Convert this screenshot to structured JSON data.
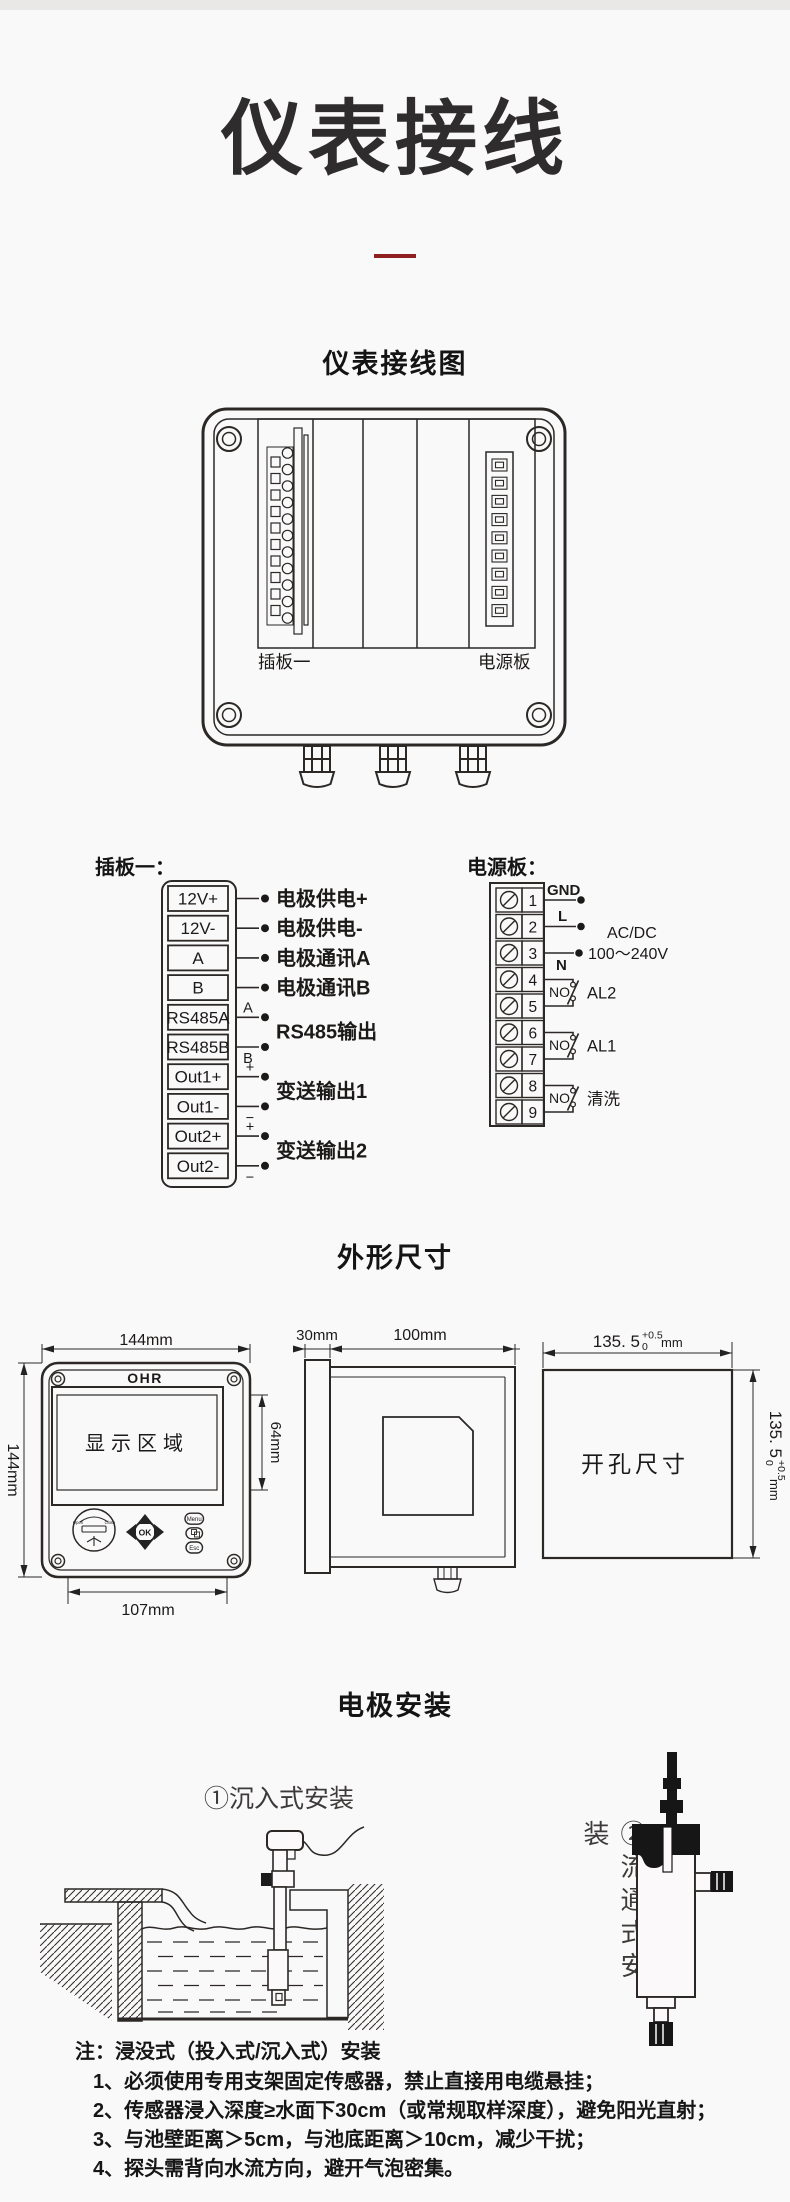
{
  "page": {
    "title": "仪表接线",
    "section_wiring_heading": "仪表接线图",
    "section_dimensions_heading": "外形尺寸",
    "section_electrode_heading": "电极安装",
    "colors": {
      "accent_red": "#8e2020",
      "line": "#2b2826",
      "background": "#faf9f9"
    }
  },
  "enclosure": {
    "left_slot_label": "插板一",
    "right_slot_label": "电源板"
  },
  "plugboard": {
    "title": "插板一：",
    "terminals": [
      "12V+",
      "12V-",
      "A",
      "B",
      "RS485A",
      "RS485B",
      "Out1+",
      "Out1-",
      "Out2+",
      "Out2-"
    ],
    "labels": {
      "supply_pos": "电极供电+",
      "supply_neg": "电极供电-",
      "comm_a": "电极通讯A",
      "comm_b": "电极通讯B",
      "rs485": "RS485输出",
      "rs485_a": "A",
      "rs485_b": "B",
      "out1": "变送输出1",
      "out2": "变送输出2",
      "plus": "+",
      "minus": "−"
    }
  },
  "powerboard": {
    "title": "电源板：",
    "terminals": [
      "1",
      "2",
      "3",
      "4",
      "5",
      "6",
      "7",
      "8",
      "9"
    ],
    "labels": {
      "gnd": "GND",
      "live": "L",
      "neutral": "N",
      "acdc_line1": "AC/DC",
      "acdc_line2": "100～240V",
      "no": "NO",
      "al2": "AL2",
      "al1": "AL1",
      "wash": "清洗"
    }
  },
  "dimensions": {
    "front": {
      "logo": "OHR",
      "display_label": "显示区域",
      "width": "144mm",
      "height": "144mm",
      "screen_height": "64mm",
      "bottom_width": "107mm",
      "btn_menu": "Menu",
      "btn_ok": "OK",
      "btn_esc": "Esc",
      "usb_open": "Open",
      "usb_close": "Close"
    },
    "side": {
      "bezel": "30mm",
      "depth": "100mm"
    },
    "cutout": {
      "label": "开孔尺寸",
      "value": "135. 5",
      "tol_sup": "+0.5",
      "tol_sub": "0",
      "unit": "mm"
    }
  },
  "installation": {
    "immersion_title": "①沉入式安装",
    "flow_title": "②流通式安装"
  },
  "notes": {
    "title": "注：浸没式（投入式/沉入式）安装",
    "items": [
      "1、必须使用专用支架固定传感器，禁止直接用电缆悬挂；",
      "2、传感器浸入深度≥水面下30cm（或常规取样深度），避免阳光直射；",
      "3、与池壁距离＞5cm，与池底距离＞10cm，减少干扰；",
      "4、探头需背向水流方向，避开气泡密集。"
    ]
  }
}
